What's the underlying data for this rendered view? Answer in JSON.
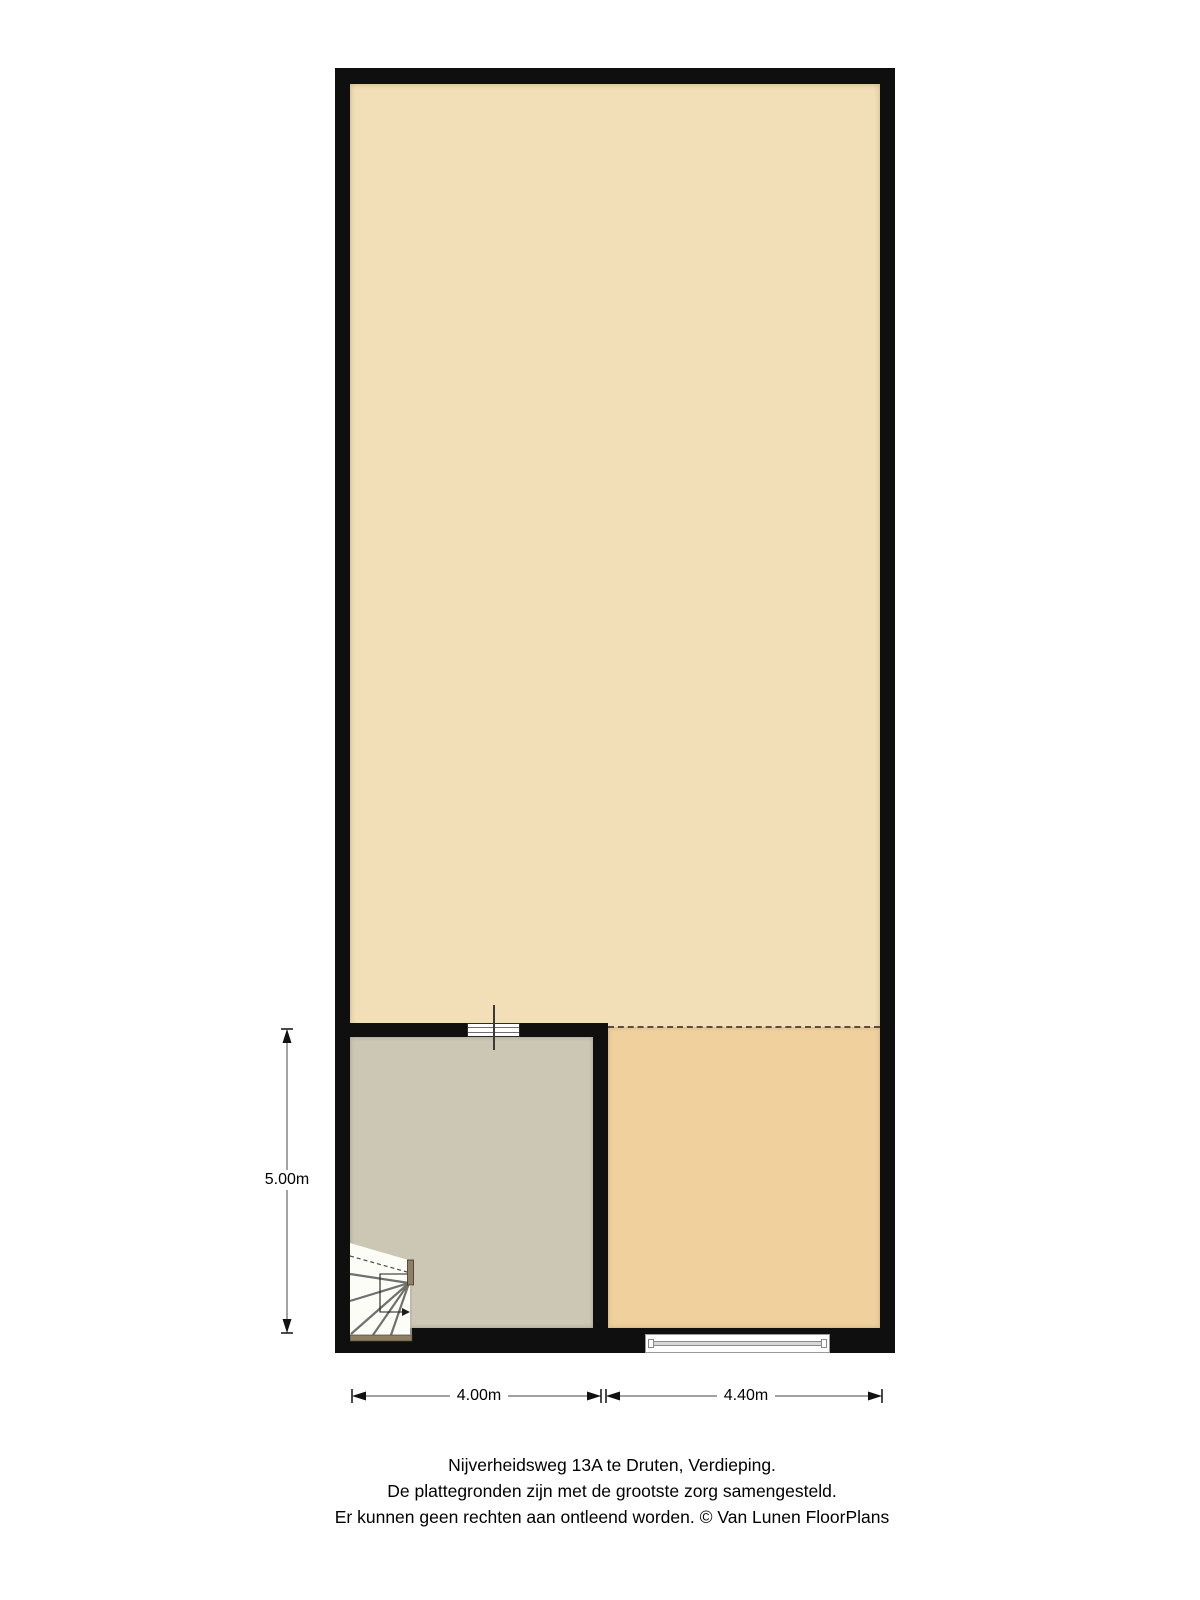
{
  "floorplan": {
    "dimensions": {
      "left_height": "5.00m",
      "bottom_left_width": "4.00m",
      "bottom_right_width": "4.40m"
    },
    "caption": {
      "line1": "Nijverheidsweg 13A te Druten, Verdieping.",
      "line2": "De plattegronden zijn met de grootste zorg samengesteld.",
      "line3": "Er kunnen geen rechten aan ontleend worden. © Van Lunen FloorPlans"
    },
    "colors": {
      "wall": "#0f0f0f",
      "attic_floor": "#f3dfb7",
      "open_area": "#f0d19e",
      "stair_room": "#ccc7b5",
      "stair_accent": "#8f7f63",
      "dim_line": "#444444",
      "text": "#000000"
    },
    "icons": {
      "staircase": "winder-stair fan shape with up-arrow walk line",
      "window_interior": "white rect with parallel lines",
      "window_exterior": "white rect with center glass band",
      "dimension_arrow": "filled triangle with end tick"
    }
  }
}
